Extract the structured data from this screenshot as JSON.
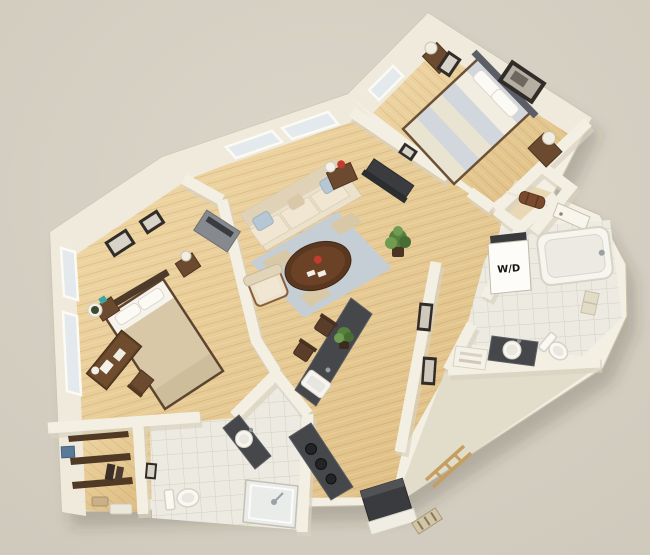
{
  "image": {
    "kind": "3d-isometric-apartment-floorplan-render",
    "width": 650,
    "height": 555
  },
  "labels": {
    "washer_dryer": "W/D"
  },
  "colors": {
    "background": "#d7d1c5",
    "background_edge": "#cdc7ba",
    "wall": "#f3efe3",
    "wall_face": "#efeadc",
    "wall_shade": "#d9d2c0",
    "wall_edge": "#c9c2af",
    "wood": "#e8cd9c",
    "tile": "#eceae1",
    "rug_blue": "#c5ced4",
    "rug_tan": "#d8c8a6",
    "sofa_cream": "#ece1cb",
    "sofa_trim": "#8a5f3c",
    "pillow_blue": "#b5c7d4",
    "table_brown": "#5a381f",
    "counter_dark": "#46474b",
    "counter_edge": "#5d5f63",
    "bed1_stripe_a": "#d2d7dd",
    "bed1_stripe_b": "#e9e3d2",
    "bed2_duvet": "#d9c8a8",
    "white_fixture": "#f9f8f3",
    "plant_green": "#57803c",
    "wood_furniture": "#6b4a2f",
    "frame_dark": "#312c27",
    "accent_red": "#c23b2e",
    "accent_teal": "#3aa6a0",
    "glass": "#e3e9ec",
    "label_ink": "#151515",
    "shadow": "rgba(60,50,35,0.22)"
  },
  "rooms": [
    {
      "id": "bedroom-1",
      "furniture": [
        "striped-queen-bed",
        "headboard",
        "nightstand-left",
        "nightstand-right",
        "table-lamps",
        "wall-art-small",
        "wall-art-large",
        "windows"
      ]
    },
    {
      "id": "living-room",
      "furniture": [
        "sofa",
        "throw-pillows",
        "oval-coffee-table",
        "armchair",
        "area-rug",
        "tv-console",
        "side-table",
        "floor-plant",
        "windows"
      ]
    },
    {
      "id": "bedroom-2",
      "furniture": [
        "queen-bed",
        "nightstands",
        "table-lamps",
        "desk",
        "desk-chair",
        "tv-dresser",
        "wall-art",
        "windows",
        "round-planter"
      ]
    },
    {
      "id": "kitchen-dining",
      "furniture": [
        "island-counter-with-sink",
        "bar-stools",
        "cooktop-counter",
        "refrigerator",
        "potted-plant",
        "door-mat"
      ]
    },
    {
      "id": "bathroom-1",
      "furniture": [
        "bathtub",
        "toilet",
        "dark-vanity-with-sink",
        "washer-dryer-closet",
        "towel-rack",
        "towel-shelf"
      ]
    },
    {
      "id": "bathroom-2",
      "furniture": [
        "toilet",
        "dark-vanity-with-sink",
        "shower-stall",
        "wall-art-small"
      ]
    },
    {
      "id": "walk-in-closet",
      "furniture": [
        "shelves",
        "storage-bin",
        "baskets"
      ]
    },
    {
      "id": "entry",
      "furniture": [
        "entry-door",
        "closet-shelf",
        "duffel-bag"
      ]
    },
    {
      "id": "hallway",
      "furniture": [
        "wall-art-pair",
        "ladder-shelf"
      ]
    }
  ]
}
